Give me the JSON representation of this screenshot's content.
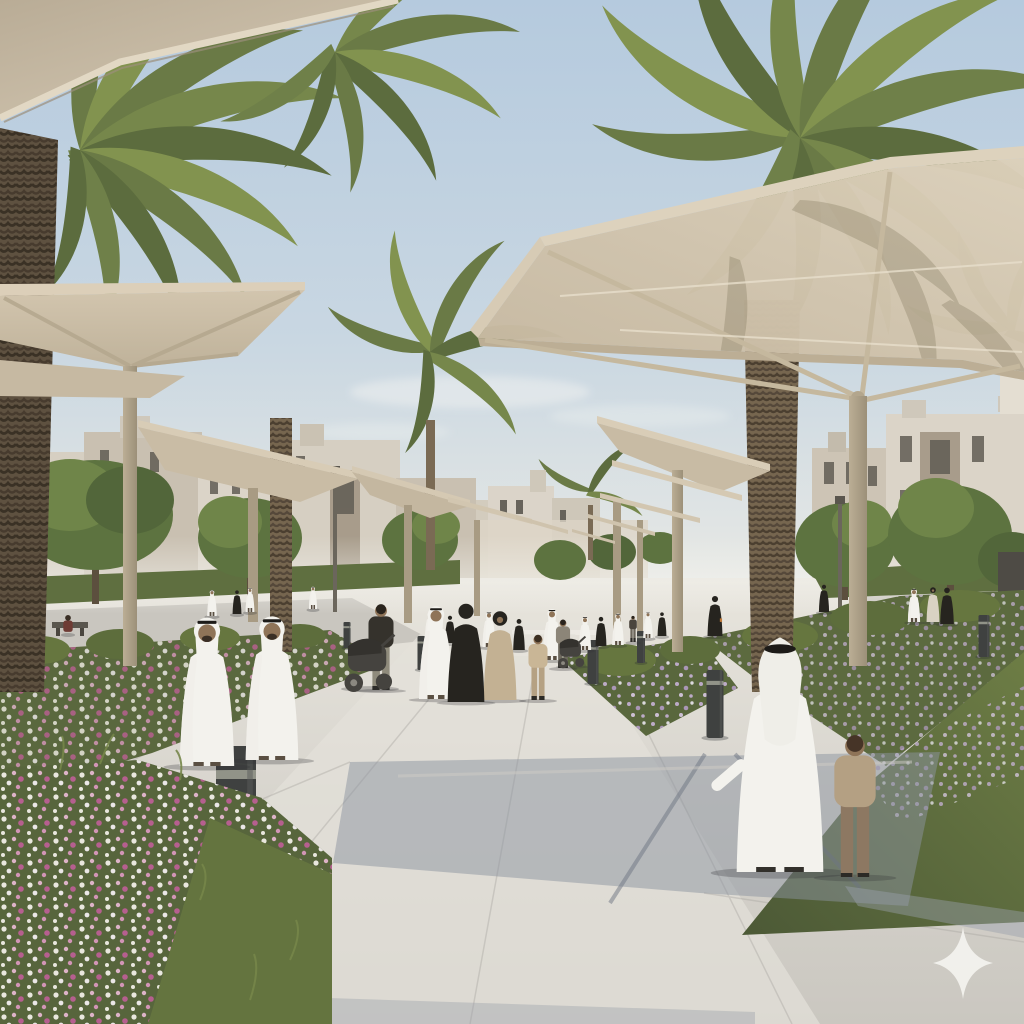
{
  "image": {
    "watermark": {
      "icon": "four-point-star-icon",
      "color": "#f4f3ef"
    }
  },
  "palette": {
    "sky_top": "#b5cade",
    "sky_mid": "#c9d7e2",
    "sky_low": "#e3e6e4",
    "cloud": "#f3f4f1",
    "canopy_top": "#dccfb9",
    "canopy_fabric": "#cdbfa7",
    "canopy_under": "#bfb199",
    "canopy_edge": "#e2d8c4",
    "canopy_frame": "#c5b89e",
    "post": "#b3a68d",
    "post_shade": "#968a74",
    "building_light": "#dbd4c8",
    "building_mid": "#c9c0b1",
    "building_recess": "#a2968488",
    "window": "#615d54",
    "tree_dark": "#52663a",
    "tree_mid": "#5d7340",
    "tree_light": "#6f8549",
    "hedge": "#5f6f40",
    "grass": "#6d7d45",
    "grass_shadow": "#4c5936",
    "bed_green": "#5a683e",
    "trunk": "#76664f",
    "trunk_dark": "#5e5140",
    "pave_far": "#e8e5dd",
    "pave_near": "#cac7c0",
    "street": "#c9c6bf",
    "shadow_blue": "#8c93a0",
    "flower_white": "#f1eee6",
    "flower_pink": "#e4b7cf",
    "flower_magenta": "#bb5f93",
    "flower_lavender": "#b39cc4",
    "white_robe": "#f3f2ed",
    "robe_shade": "#efeee8",
    "black_cloth": "#26241f",
    "beige_cloth": "#c3b193",
    "skin": "#8f7458",
    "hair": "#3a2f25",
    "agal": "#1d1b18",
    "stroller": "#45433f",
    "bollard": "#3f4140",
    "bollard_band": "#9a9c90",
    "sparkle": "#f4f3ef"
  },
  "scene": {
    "people": [
      {
        "type": "kandura-front",
        "x": 207,
        "y": 766,
        "h": 160
      },
      {
        "type": "kandura-front",
        "x": 272,
        "y": 760,
        "h": 155
      },
      {
        "type": "casual",
        "x": 381,
        "y": 690,
        "h": 92,
        "top": "#35322c",
        "legs": "#8f8b7c",
        "hair": "#2a241d"
      },
      {
        "type": "kandura-front",
        "x": 436,
        "y": 699,
        "h": 100
      },
      {
        "type": "abaya",
        "x": 466,
        "y": 702,
        "h": 108
      },
      {
        "type": "hijab-dress",
        "x": 500,
        "y": 700,
        "h": 97,
        "robe": "#c3b193"
      },
      {
        "type": "casual",
        "x": 538,
        "y": 700,
        "h": 70,
        "top": "#c9b696",
        "legs": "#b5a183",
        "hair": "#3c2f22"
      },
      {
        "type": "kandura-front",
        "x": 552,
        "y": 660,
        "h": 55
      },
      {
        "type": "casual",
        "x": 563,
        "y": 668,
        "h": 52,
        "top": "#8c8578",
        "legs": "#6e695e",
        "hair": "#2a241d"
      },
      {
        "type": "abaya",
        "x": 715,
        "y": 636,
        "h": 44,
        "bag": true
      },
      {
        "type": "kandura-back",
        "x": 780,
        "y": 872,
        "h": 255
      },
      {
        "type": "casual",
        "x": 855,
        "y": 877,
        "h": 152,
        "top": "#b4a083",
        "legs": "#8d7862",
        "hair": "#463427"
      },
      {
        "type": "kandura-front",
        "x": 914,
        "y": 622,
        "h": 36
      },
      {
        "type": "hijab-dress",
        "x": 933,
        "y": 622,
        "h": 38,
        "robe": "#d9d2c3"
      },
      {
        "type": "abaya",
        "x": 947,
        "y": 624,
        "h": 40
      },
      {
        "type": "abaya",
        "x": 824,
        "y": 612,
        "h": 30
      },
      {
        "type": "kandura-front",
        "x": 212,
        "y": 616,
        "h": 28
      },
      {
        "type": "abaya",
        "x": 237,
        "y": 614,
        "h": 26
      },
      {
        "type": "kandura-front",
        "x": 250,
        "y": 612,
        "h": 26
      },
      {
        "type": "kandura-front",
        "x": 313,
        "y": 609,
        "h": 24
      },
      {
        "type": "seated",
        "x": 68,
        "y": 634,
        "h": 26,
        "top": "#6e3b34"
      },
      {
        "type": "kandura-front",
        "x": 489,
        "y": 647,
        "h": 38
      },
      {
        "type": "abaya",
        "x": 519,
        "y": 650,
        "h": 34
      },
      {
        "type": "kandura-front",
        "x": 585,
        "y": 650,
        "h": 36
      },
      {
        "type": "abaya",
        "x": 601,
        "y": 646,
        "h": 32
      },
      {
        "type": "kandura-front",
        "x": 618,
        "y": 645,
        "h": 34
      },
      {
        "type": "casual",
        "x": 633,
        "y": 642,
        "h": 28,
        "top": "#4a443c",
        "legs": "#6b655a",
        "hair": "#2a241d"
      },
      {
        "type": "kandura-front",
        "x": 648,
        "y": 638,
        "h": 28
      },
      {
        "type": "abaya",
        "x": 662,
        "y": 636,
        "h": 26
      },
      {
        "type": "kandura-front",
        "x": 430,
        "y": 640,
        "h": 30
      },
      {
        "type": "abaya",
        "x": 450,
        "y": 643,
        "h": 30
      }
    ],
    "strollers": [
      {
        "x": 370,
        "y": 688,
        "s": 58
      },
      {
        "x": 572,
        "y": 666,
        "s": 32
      }
    ],
    "bollards": [
      {
        "x": 236,
        "y": 896,
        "w": 40,
        "h": 150
      },
      {
        "x": 715,
        "y": 738,
        "w": 17,
        "h": 68
      },
      {
        "x": 593,
        "y": 684,
        "w": 11,
        "h": 44
      },
      {
        "x": 641,
        "y": 663,
        "w": 8,
        "h": 32
      },
      {
        "x": 422,
        "y": 670,
        "w": 9,
        "h": 34
      },
      {
        "x": 984,
        "y": 657,
        "w": 11,
        "h": 42
      },
      {
        "x": 347,
        "y": 648,
        "w": 7,
        "h": 26
      }
    ],
    "sparkle": {
      "cx": 963,
      "cy": 963,
      "rx": 30,
      "ry": 36
    }
  }
}
